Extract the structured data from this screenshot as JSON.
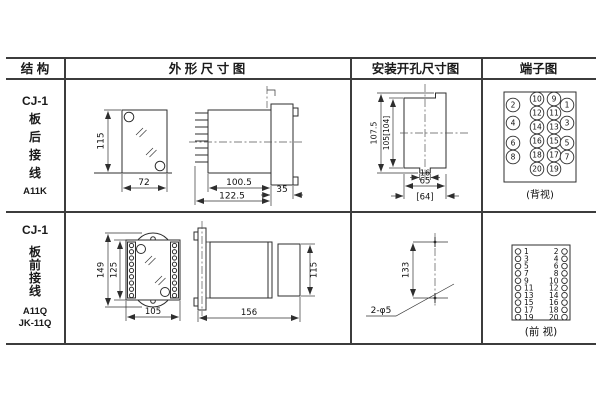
{
  "header": {
    "col1": "结 构",
    "col2": "外 形 尺 寸 图",
    "col3": "安装开孔尺寸图",
    "col4": "端子图"
  },
  "rows": [
    {
      "structure": {
        "model": "CJ-1",
        "l1": "板",
        "l2": "后",
        "l3": "接",
        "l4": "线",
        "code": "A11K"
      },
      "outline": {
        "front_height": "115",
        "front_width": "72",
        "side_depth_inner": "100.5",
        "side_depth_outer": "122.5",
        "side_flange": "35"
      },
      "mounting": {
        "v_outer": "107.5",
        "v_inner": "105[104]",
        "h_notch": "16",
        "h_width": "65",
        "h_width_alt": "[64]"
      },
      "terminal": {
        "view": "(背视)",
        "mid_left": [
          "10",
          "12",
          "14",
          "16",
          "18",
          "20"
        ],
        "mid_right": [
          "9",
          "11",
          "13",
          "15",
          "17",
          "19"
        ],
        "outer_left": [
          "2",
          "4",
          "6",
          "8"
        ],
        "outer_right": [
          "1",
          "3",
          "5",
          "7"
        ]
      }
    },
    {
      "structure": {
        "model": "CJ-1",
        "l1": "板",
        "l2": "前",
        "l3": "接",
        "l4": "线",
        "code": "A11Q",
        "code2": "JK-11Q"
      },
      "outline": {
        "front_h_outer": "149",
        "front_h_inner": "125",
        "front_width": "105",
        "side_depth": "156",
        "side_height": "115"
      },
      "mounting": {
        "v": "133",
        "holes": "2-φ5"
      },
      "terminal": {
        "view": "(前 视)",
        "left": [
          "1",
          "3",
          "5",
          "7",
          "9",
          "11",
          "13",
          "15",
          "17",
          "19"
        ],
        "right": [
          "2",
          "4",
          "6",
          "8",
          "10",
          "12",
          "14",
          "16",
          "18",
          "20"
        ]
      }
    }
  ]
}
